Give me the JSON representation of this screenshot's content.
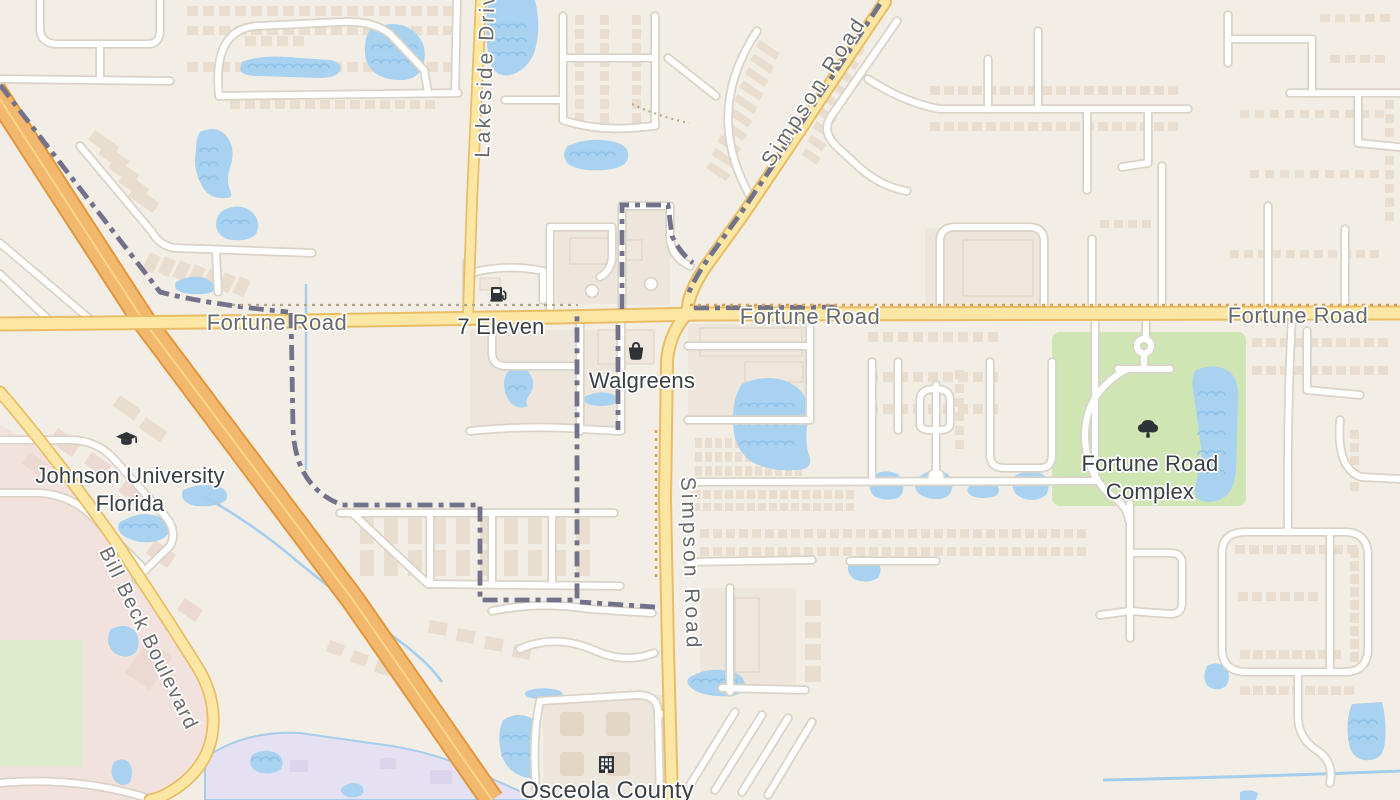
{
  "map": {
    "roads": {
      "fortune": "Fortune Road",
      "simpson": "Simpson Road",
      "lakeside": "Lakeside Drive",
      "bill_beck": "Bill Beck Boulevard"
    },
    "pois": {
      "seven_eleven": "7 Eleven",
      "walgreens": "Walgreens",
      "johnson_university_line1": "Johnson University",
      "johnson_university_line2": "Florida",
      "fortune_complex_line1": "Fortune Road",
      "fortune_complex_line2": "Complex",
      "osceola_county": "Osceola County"
    },
    "icon_names": {
      "seven_eleven": "fuel-pump-icon",
      "walgreens": "shopping-bag-icon",
      "johnson_university": "graduation-cap-icon",
      "fortune_complex": "tree-icon",
      "osceola_county": "government-building-icon"
    },
    "colors": {
      "background": "#f3eee5",
      "water": "#a9d2f0",
      "wave": "#8ec0e5",
      "stream": "#a5cdec",
      "park": "#cfe5b4",
      "field": "#dcebcb",
      "campus": "#f2e2dd",
      "special_district": "#e6e1f2",
      "road_fill": "#ffffff",
      "road_casing": "#d9d3c8",
      "major_fill": "#fbe7a3",
      "major_casing": "#e9bd66",
      "highway_fill": "#f2b96e",
      "highway_casing": "#e2973d",
      "highway_median": "#f9d489",
      "building": "#e9ddcf",
      "structure": "#efe7dd",
      "structure_stroke": "#dcd1c2",
      "campus_building": "#ecd9d2",
      "pad": "#ece6dc",
      "boundary": "#72738b",
      "boundary_dot_orange": "#dd9f4a",
      "boundary_dot_tan": "#b3a58c",
      "road_label": "#67696b",
      "poi_label": "#3a4044"
    }
  }
}
